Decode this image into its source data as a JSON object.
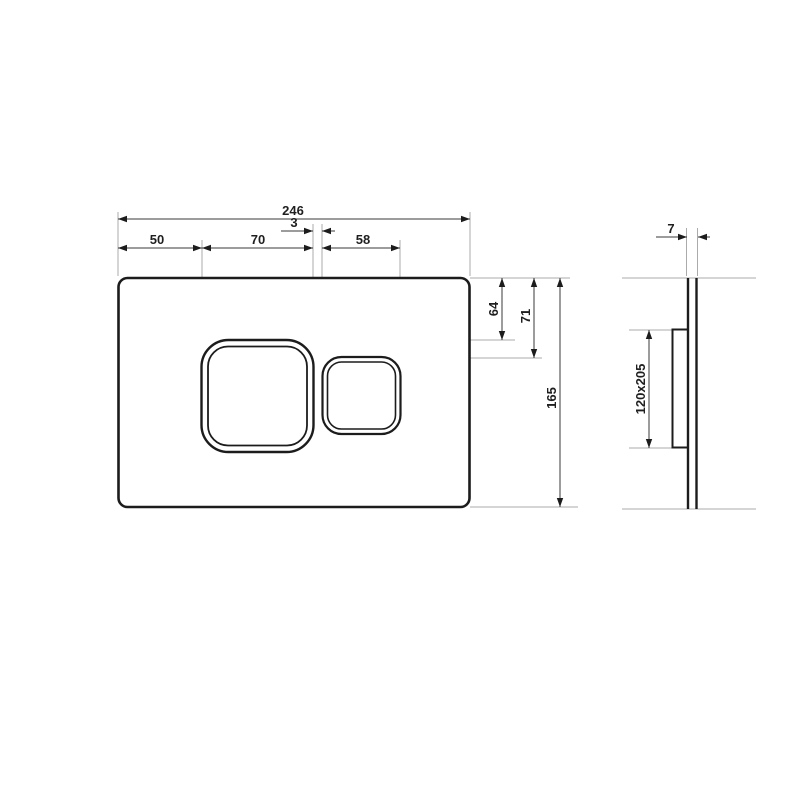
{
  "drawing": {
    "type": "technical-dimension-drawing",
    "subject": "flush-plate with two buttons, front and side view",
    "colors": {
      "background": "#ffffff",
      "part_outline": "#1c1c1c",
      "dimension_line": "#3a3a3a",
      "extension_line": "#ababab",
      "label_text": "#1f1f1f"
    },
    "front_view": {
      "dims": {
        "overall_width": "246",
        "button_gap": "3",
        "left_offset": "50",
        "large_button_width": "70",
        "small_button_width": "58",
        "large_button_top_offset": "64",
        "small_button_top_offset": "71",
        "overall_height": "165"
      }
    },
    "side_view": {
      "dims": {
        "plate_thickness": "7",
        "frame_size": "120x205"
      }
    }
  }
}
